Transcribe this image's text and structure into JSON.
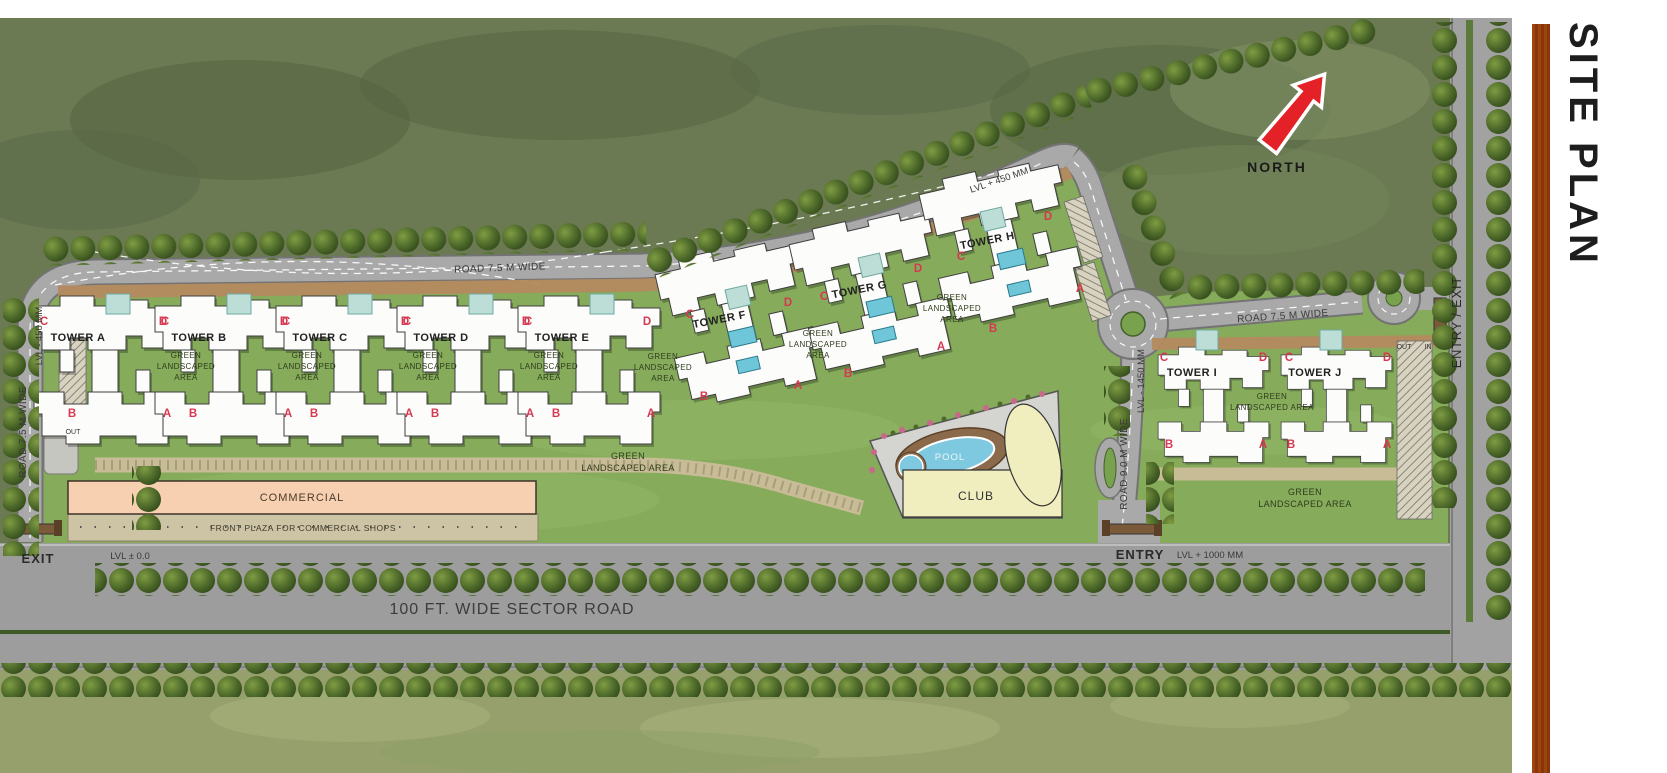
{
  "panel": {
    "title": "SITE PLAN"
  },
  "compass": {
    "north": "NORTH"
  },
  "towers": {
    "a": "TOWER A",
    "b": "TOWER B",
    "c": "TOWER C",
    "d": "TOWER D",
    "e": "TOWER E",
    "f": "TOWER F",
    "g": "TOWER G",
    "h": "TOWER H",
    "i": "TOWER I",
    "j": "TOWER J"
  },
  "units": {
    "a": "A",
    "b": "B",
    "c": "C",
    "d": "D"
  },
  "green": {
    "l1": "GREEN",
    "l2": "LANDSCAPED",
    "l3": "AREA",
    "l23": "LANDSCAPED AREA"
  },
  "amenities": {
    "club": "CLUB",
    "pool": "POOL",
    "commercial": "COMMERCIAL",
    "front_plaza": "FRONT PLAZA FOR COMMERCIAL SHOPS"
  },
  "roads": {
    "r75": "ROAD 7.5 M WIDE",
    "r90": "ROAD 9.0 M WIDE",
    "sector": "100 FT. WIDE SECTOR ROAD"
  },
  "levels": {
    "top": "LVL + 450 MM",
    "left": "LVL - 450 MM",
    "south": "LVL - 1450 MM",
    "entry": "LVL + 1000 MM",
    "zero": "LVL ± 0.0"
  },
  "gates": {
    "entry": "ENTRY",
    "exit": "EXIT",
    "entry_exit": "ENTRY / EXIT",
    "in": "IN",
    "out": "OUT"
  },
  "colors": {
    "accent_red": "#e32126",
    "unit_letter": "#d63850",
    "orange_bar": "#c07a35",
    "lawn": "#85ab5b",
    "road": "#a9a9a9",
    "pool_blue": "#7ec8e0",
    "club_yellow": "#f0eebf",
    "commercial_peach": "#f6d0b0"
  }
}
